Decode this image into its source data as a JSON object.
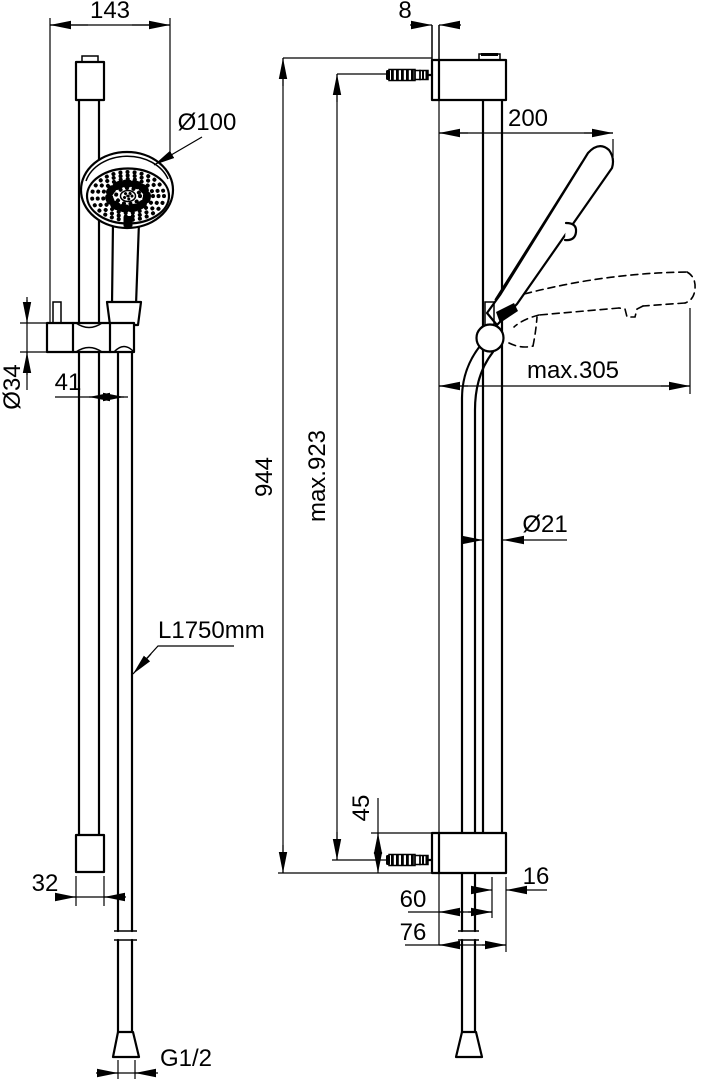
{
  "front_view": {
    "dims": {
      "top_width": "143",
      "head_diameter": "Ø100",
      "slider_diameter": "Ø34",
      "axis_offset": "41",
      "hose_length": "L1750mm",
      "end_cap_width": "32",
      "thread": "G1/2"
    }
  },
  "side_view": {
    "dims": {
      "wall_gap": "8",
      "reach": "200",
      "max_reach": "max.305",
      "rail_length": "944",
      "max_fixing_distance": "max.923",
      "rail_diameter": "Ø21",
      "bracket_height": "45",
      "axis_to_front": "16",
      "wall_to_axis": "60",
      "bracket_depth": "76"
    }
  },
  "style": {
    "line_color": "#000000",
    "background": "#ffffff"
  }
}
